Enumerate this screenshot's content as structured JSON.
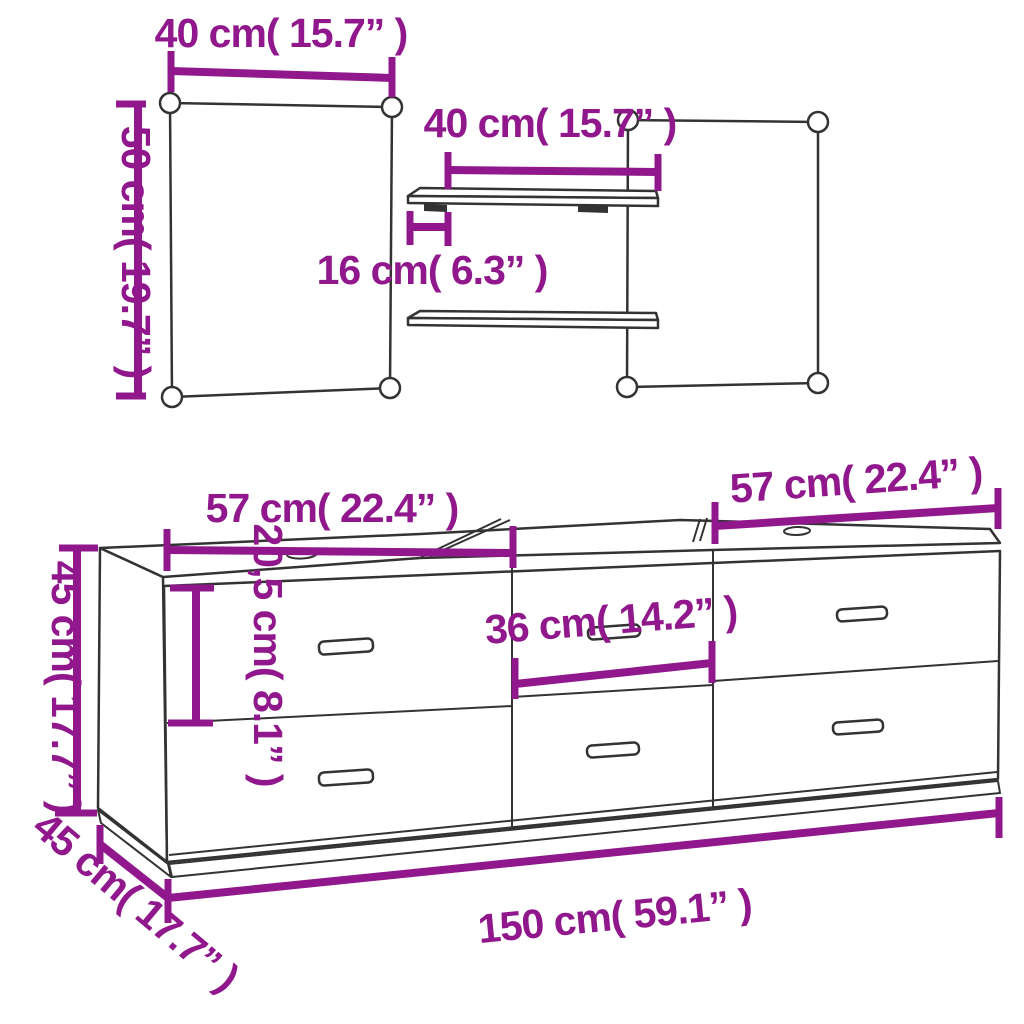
{
  "diagram": {
    "type": "furniture-dimension-diagram",
    "colors": {
      "dimension": "#90188C",
      "outline": "#333333",
      "background": "#FFFFFF"
    },
    "wall_unit": {
      "panel_width_label": "40 cm( 15.7” )",
      "panel_height_label": "50 cm( 19.7” )",
      "shelf_width_label": "40 cm( 15.7” )",
      "shelf_depth_label": "16 cm( 6.3” )"
    },
    "cabinet": {
      "left_section_width_label": "57 cm( 22.4” )",
      "right_section_width_label": "57 cm( 22.4” )",
      "middle_section_width_label": "36 cm( 14.2” )",
      "drawer_height_label": "20,5 cm( 8.1” )",
      "height_label": "45 cm( 17.7” )",
      "depth_label": "45 cm( 17.7” )",
      "total_width_label": "150 cm( 59.1” )"
    }
  }
}
